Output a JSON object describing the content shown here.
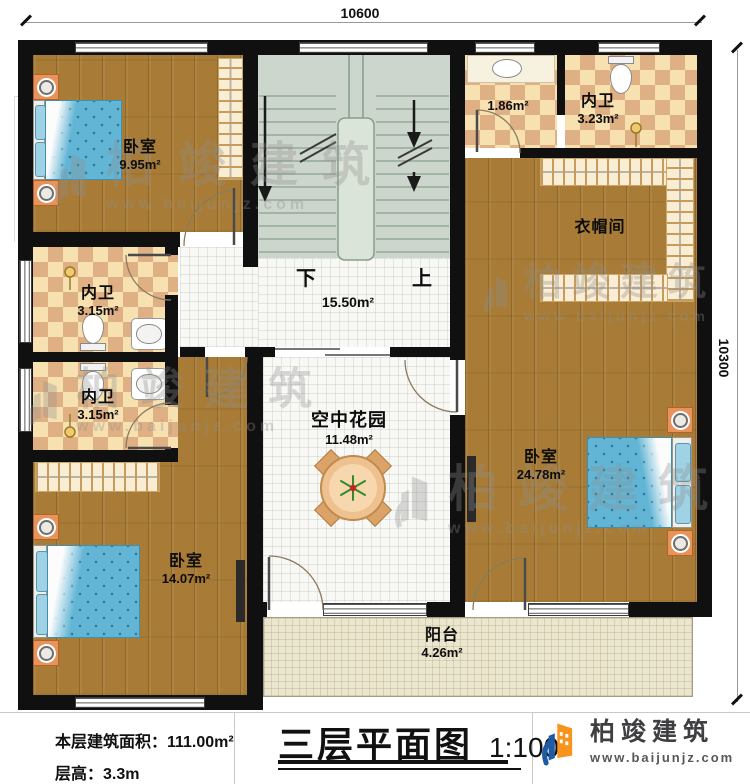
{
  "dimensions": {
    "top": "10600",
    "right": "10300"
  },
  "rooms": {
    "bedroom_top_left": {
      "name": "卧室",
      "area": "9.95m²"
    },
    "bath_top_small": {
      "area": "1.86m²"
    },
    "bath_top_right": {
      "name": "内卫",
      "area": "3.23m²"
    },
    "cloakroom": {
      "name": "衣帽间"
    },
    "bath_mid_upper": {
      "name": "内卫",
      "area": "3.15m²"
    },
    "bath_mid_lower": {
      "name": "内卫",
      "area": "3.15m²"
    },
    "stair_hall": {
      "area": "15.50m²",
      "down_label": "下",
      "up_label": "上"
    },
    "sky_garden": {
      "name": "空中花园",
      "area": "11.48m²"
    },
    "bedroom_right": {
      "name": "卧室",
      "area": "24.78m²"
    },
    "bedroom_bottom_left": {
      "name": "卧室",
      "area": "14.07m²"
    },
    "balcony": {
      "name": "阳台",
      "area": "4.26m²"
    }
  },
  "footer": {
    "floor_area": "本层建筑面积：111.00m²",
    "floor_height": "层高：3.3m",
    "title": "三层平面图",
    "scale": "1:100",
    "brand_name": "柏竣建筑",
    "brand_url": "www.baijunjz.com"
  },
  "watermark": {
    "name": "柏竣建筑",
    "url": "www.baijunjz.com"
  },
  "colors": {
    "wall": "#101010",
    "wood": "#a87c36",
    "tile_tan": "#dfb084",
    "tile_cream": "#f7e1b0",
    "stair": "#cdd6cc",
    "balcony": "#ebe6cf",
    "bed_blue": "#62b5d5",
    "brand_blue": "#1d5ba4",
    "brand_orange": "#f7941d"
  }
}
